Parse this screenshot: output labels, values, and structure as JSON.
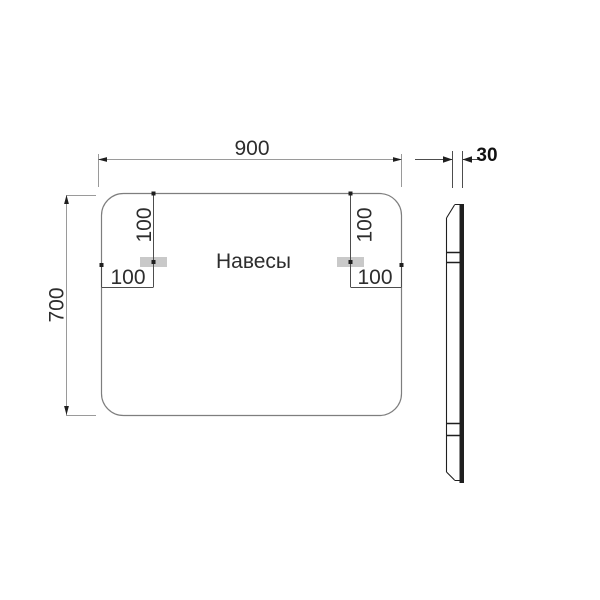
{
  "front_view": {
    "label": "Навесы",
    "width_label": "900",
    "height_label": "700",
    "left_hanger": {
      "top_offset_label": "100",
      "side_offset_label": "100"
    },
    "right_hanger": {
      "top_offset_label": "100",
      "side_offset_label": "100"
    }
  },
  "side_view": {
    "depth_label": "30"
  },
  "colors": {
    "outline": "#7e7e7e",
    "dimlight": "#9a9a9a",
    "dimdark": "#4d4d4d",
    "dark": "#1f1f1f",
    "textc": "#2d2d2d",
    "hanger": "#c9c9c9"
  }
}
